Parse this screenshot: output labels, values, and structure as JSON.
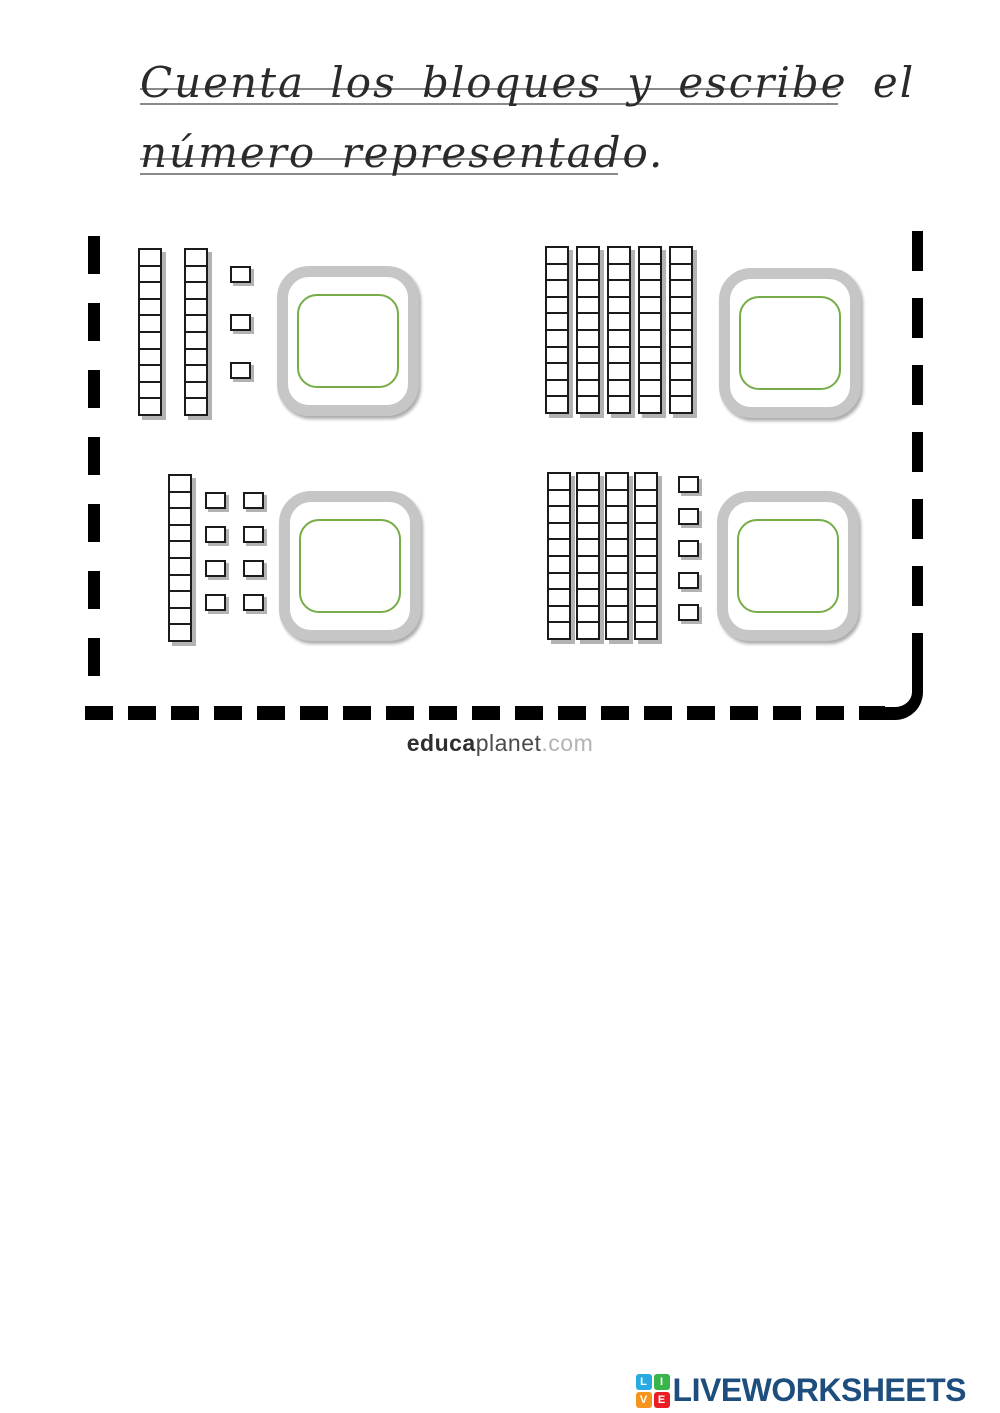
{
  "title": {
    "line1": "Cuenta los bloques y escribe el",
    "line2": "número representado."
  },
  "worksheet": {
    "rod_cells": 10,
    "exercises": [
      {
        "position": "top-left",
        "tens": 2,
        "ones": 3,
        "answer": ""
      },
      {
        "position": "top-right",
        "tens": 5,
        "ones": 0,
        "answer": ""
      },
      {
        "position": "bottom-left",
        "tens": 1,
        "ones": 8,
        "answer": ""
      },
      {
        "position": "bottom-right",
        "tens": 4,
        "ones": 5,
        "answer": ""
      }
    ],
    "colors": {
      "block_outline": "#1b1b1b",
      "block_shadow": "#b3b3b3",
      "answer_box_border": "#c6c6c6",
      "answer_inner_border": "#76ad48",
      "dash_border": "#000000"
    }
  },
  "branding": {
    "educa": "educa",
    "planet": "planet",
    "domain": ".com"
  },
  "footer": {
    "logo_text": "LIVEWORKSHEETS",
    "logo_color": "#1d4e7e",
    "icon_letters": [
      "L",
      "I",
      "V",
      "E"
    ],
    "icon_colors": [
      "#29abe2",
      "#39b54a",
      "#f7941d",
      "#ed1c24"
    ]
  }
}
